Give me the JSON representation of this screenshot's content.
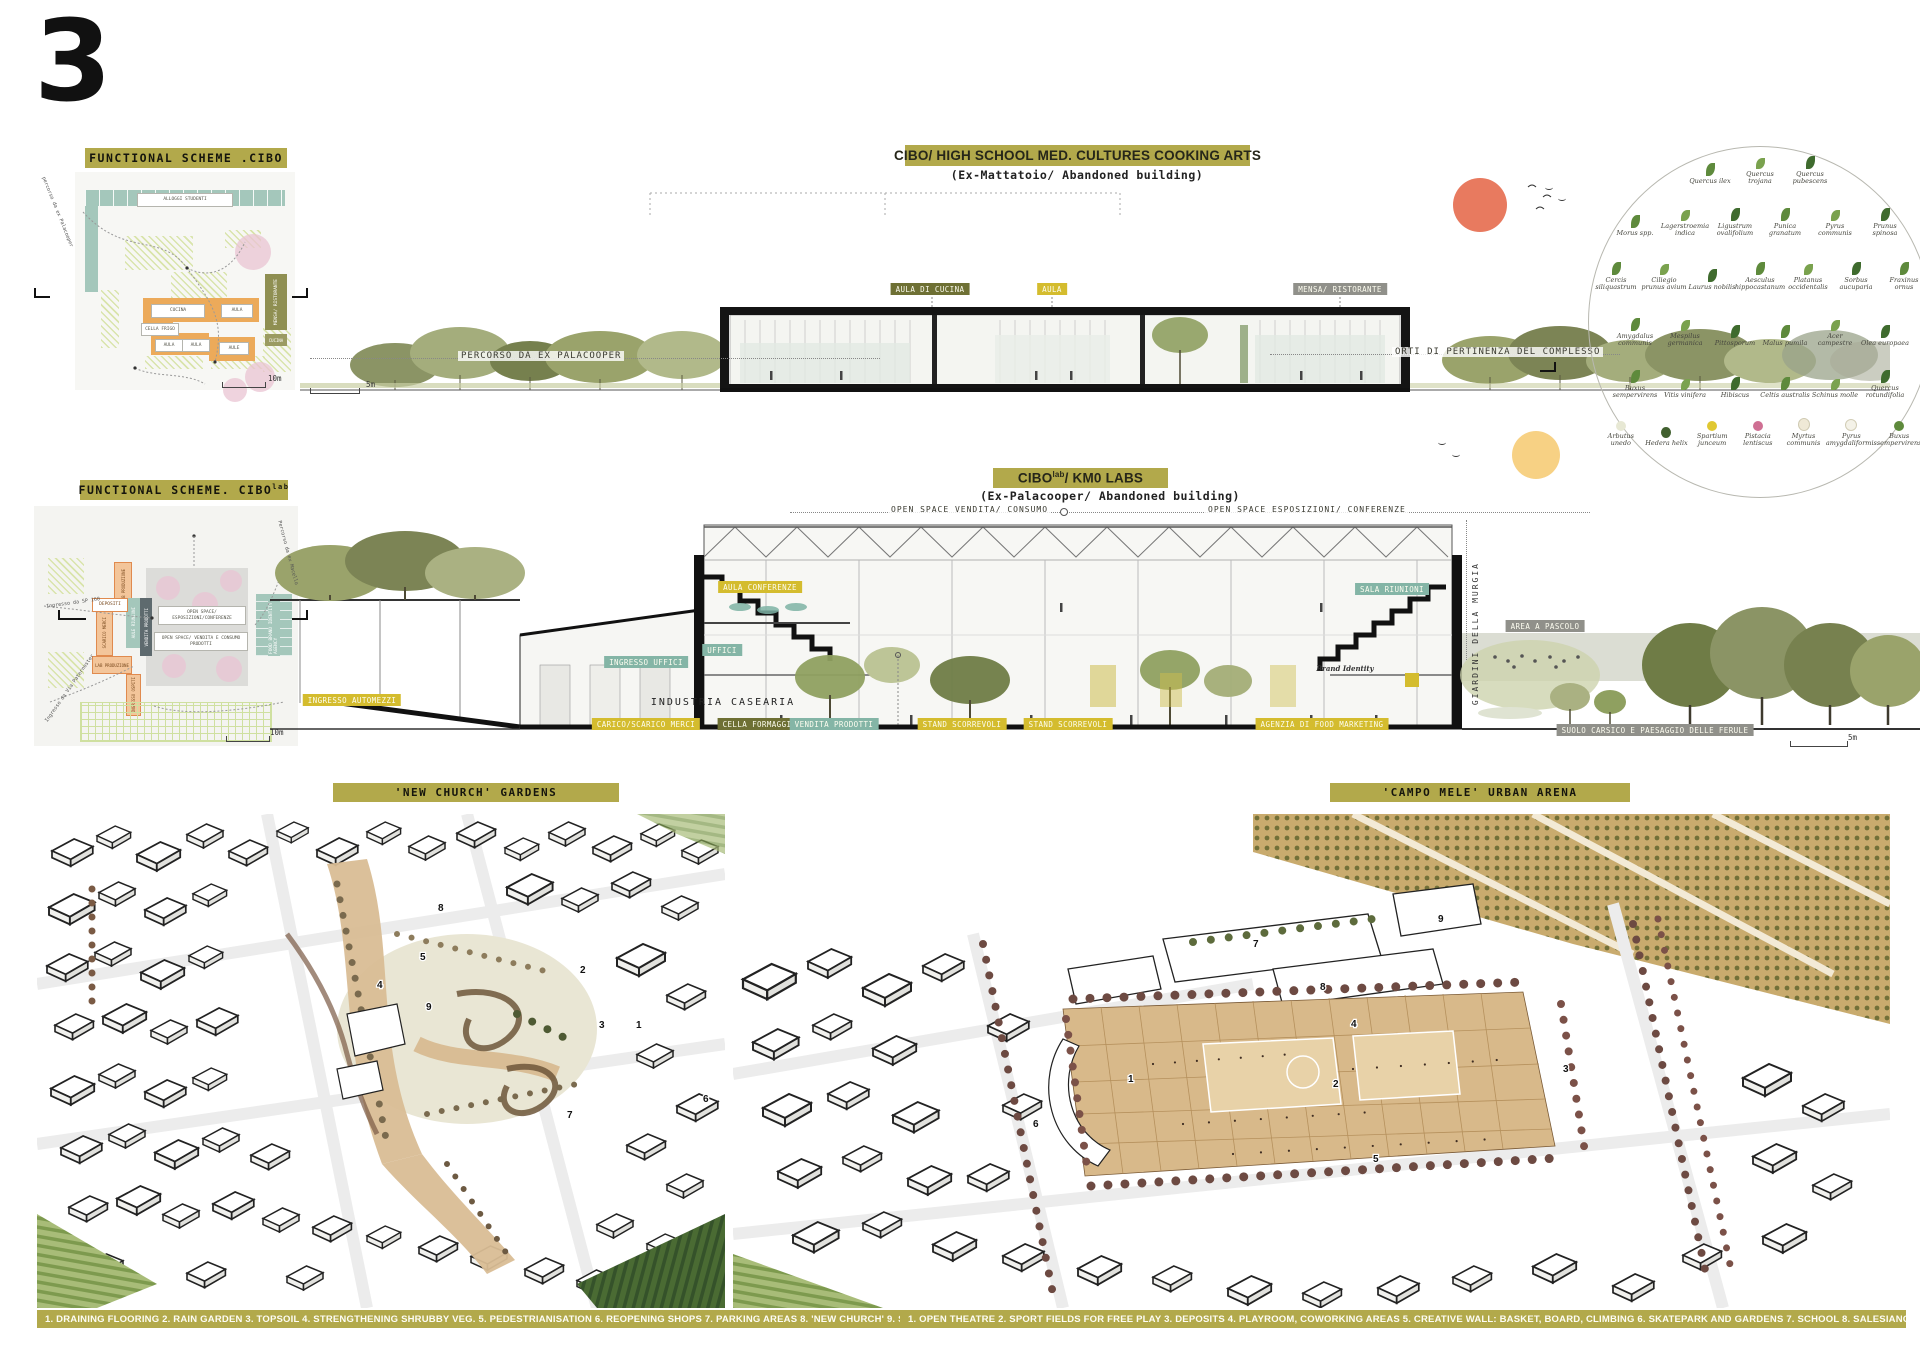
{
  "page": {
    "number": "3"
  },
  "scheme_cibo": {
    "title": "FUNCTIONAL SCHEME .CIBO",
    "alloggi": "ALLOGGI STUDENTI",
    "cucina": "CUCINA",
    "aula1": "AULA",
    "cella": "CELLA FRIGO",
    "aula2": "AULA",
    "aula3": "AULA",
    "aule": "AULE",
    "mensa": "MENSA/ RISTORANTE",
    "cucina2": "CUCINA",
    "path_label": "percorso da ex Palacooper",
    "scale": "10m"
  },
  "section_cibo": {
    "title": "CIBO/  HIGH SCHOOL MED. CULTURES COOKING ARTS",
    "subtitle": "(Ex-Mattatoio/ Abandoned building)",
    "tag_aula_cucina": "AULA DI CUCINA",
    "tag_aula": "AULA",
    "tag_mensa": "MENSA/ RISTORANTE",
    "ground_left": "PERCORSO DA EX PALACOOPER",
    "ground_right": "ORTI DI PERTINENZA DEL COMPLESSO",
    "scale": "5m"
  },
  "plants": {
    "rows": [
      [
        "Quercus ilex",
        "Quercus trojana",
        "Quercus pubescens"
      ],
      [
        "Morus spp.",
        "Lagerstroemia indica",
        "Ligustrum ovalifolium",
        "Punica granatum",
        "Pyrus communis",
        "Prunus spinosa"
      ],
      [
        "Cercis siliquastrum",
        "Ciliegio prunus avium",
        "Laurus nobilis",
        "Aesculus hippocastanum",
        "Platanus occidentalis",
        "Sorbus aucuparia",
        "Fraxinus ornus"
      ],
      [
        "Amygdalus communis",
        "Mespilus germanica",
        "Pittosporum",
        "Malus pumila",
        "Acer campestre",
        "Olea europaea"
      ],
      [
        "Buxus sempervirens",
        "Vitis vinifera",
        "Hibiscus",
        "Celtis australis",
        "Schinus molle",
        "Quercus rotundifolia"
      ],
      [
        "Arbutus unedo",
        "Hedera helix",
        "Spartium junceum",
        "Pistacia lentiscus",
        "Myrtus communis",
        "Pyrus amygdaliformis",
        "Buxus sempervirens"
      ]
    ]
  },
  "scheme_cibolab": {
    "title": "FUNCTIONAL SCHEME.  CIBO",
    "title_sup": "lab",
    "lab1": "LAB PRODUZIONE",
    "depositi": "DEPOSITI",
    "scarico": "SCARICO MERCI",
    "aule": "AULE RIUNIONI",
    "vendita": "VENDITA PRODOTTI",
    "lab2": "LAB PRODUZIONE",
    "ingresso": "INGRESSO OSPITI",
    "open1": "OPEN SPACE/ ESPOSIZIONI/CONFERENZE",
    "open2": "OPEN SPACE/ VENDITA E CONSUMO PRODOTTI",
    "food": "FOOD BRAND IDENTITY AGENCY",
    "path1": "Percorso da ex Macello",
    "path2": "Ingresso da SP 160",
    "path3": "Ingresso da Via Paternoster",
    "scale": "10m"
  },
  "section_cibolab": {
    "title": "CIBO",
    "title_sup": "lab",
    "title_rest": "/ KM0 LABS",
    "subtitle": "(Ex-Palacooper/ Abandoned building)",
    "open_left": "OPEN SPACE VENDITA/ CONSUMO",
    "open_right": "OPEN SPACE ESPOSIZIONI/ CONFERENZE",
    "tag_aula_conf": "AULA CONFERENZE",
    "tag_uffici": "UFFICI",
    "tag_ingresso_uffici": "INGRESSO UFFICI",
    "tag_sala": "SALA RIUNIONI",
    "tag_ingresso_auto": "INGRESSO AUTOMEZZI",
    "industria": "INDUSTRIA CASEARIA",
    "tag_carico": "CARICO/SCARICO MERCI",
    "tag_cella": "CELLA FORMAGGI",
    "tag_vendita": "VENDITA PRODOTTI",
    "tag_stand1": "STAND SCORREVOLI",
    "tag_stand2": "STAND SCORREVOLI",
    "tag_agenzia": "AGENZIA DI FOOD MARKETING",
    "tag_area": "AREA A PASCOLO",
    "tag_suolo": "SUOLO CARSICO E PAESAGGIO DELLE FERULE",
    "vertical": "GIARDINI DELLA MURGIA",
    "brand": "Brand Identity",
    "scale": "5m"
  },
  "axon_left": {
    "title": "'NEW CHURCH' GARDENS",
    "legend": "1. DRAINING FLOORING  2. RAIN GARDEN  3. TOPSOIL  4. STRENGTHENING SHRUBBY VEG.  5. PEDESTRIANISATION 6. REOPENING SHOPS  7. PARKING AREAS  8. 'NEW CHURCH'  9. SCHOOL",
    "markers": [
      "1",
      "2",
      "3",
      "4",
      "5",
      "6",
      "7",
      "8",
      "9"
    ]
  },
  "axon_right": {
    "title": "'CAMPO MELE' URBAN ARENA",
    "legend": "1. OPEN THEATRE  2. SPORT FIELDS FOR FREE PLAY  3. DEPOSITS  4. PLAYROOM, COWORKING AREAS 5. CREATIVE WALL: BASKET, BOARD, CLIMBING   6. SKATEPARK AND GARDENS   7. SCHOOL  8. SALESIANO INSTITUTE   9. HOSTEL AND THEATRE",
    "markers": [
      "1",
      "2",
      "3",
      "4",
      "5",
      "6",
      "7",
      "8",
      "9"
    ]
  },
  "colors": {
    "olive_bar": "#b2a94b",
    "tag_yellow": "#d4bc2e",
    "tag_olive": "#6e7034",
    "tag_teal": "#84b5a6",
    "tag_grey": "#90908a",
    "orange_block": "#ecaa5a",
    "teal_block": "#a4c7bb",
    "pink_tree": "#eac4d3",
    "sun_red": "#e87a5f",
    "sun_yellow": "#f6cd79"
  }
}
